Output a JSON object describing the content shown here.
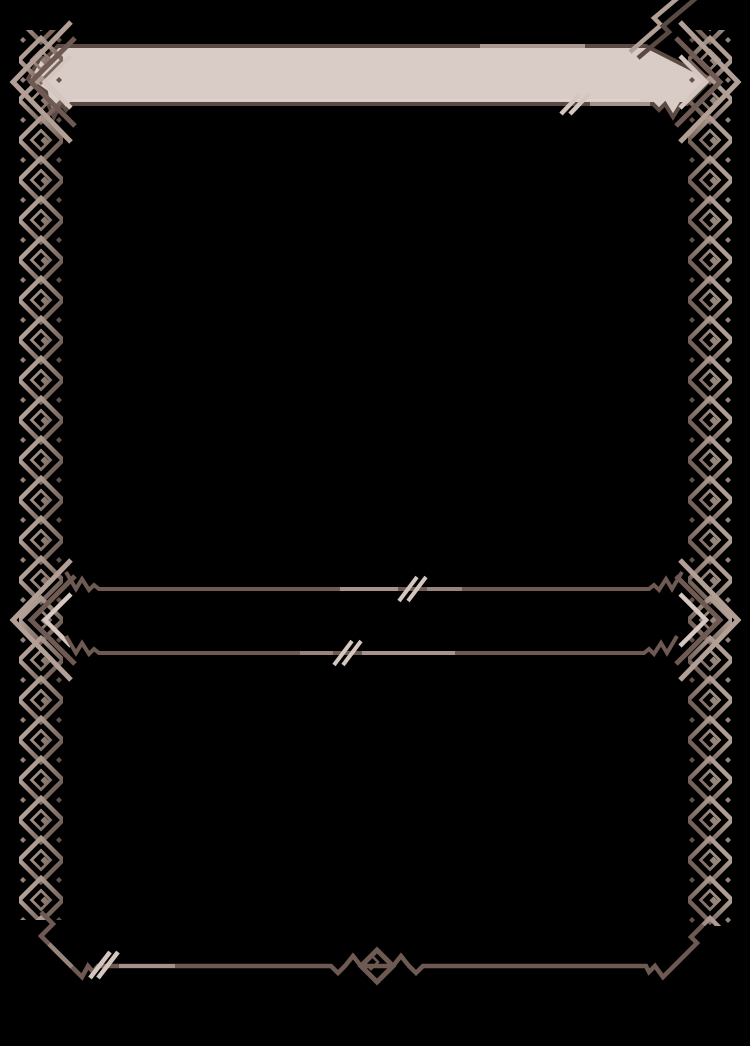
{
  "frame": {
    "banner_text": "",
    "palette": {
      "background": "#000000",
      "fill_light": "#d9ccc6",
      "line_dark": "#5b4a43",
      "line_mid": "#6e5a52",
      "taupe_light": "#b2a096",
      "taupe_lighter": "#d5c7c0",
      "grad_light": "#c6b5ab",
      "grad_dark": "#604d45"
    },
    "ornaments": {
      "banner": "title-banner",
      "top_right_accent": "lightning-bolt-icon",
      "side_borders": "diamond-chain-border",
      "side_accents": "chevron-cluster-icon",
      "dividers": "zigzag-divider",
      "divider_marks": "double-slash-icon",
      "bottom_border": "zigzag-bottom-border",
      "bottom_center": "diamond-icon"
    }
  }
}
